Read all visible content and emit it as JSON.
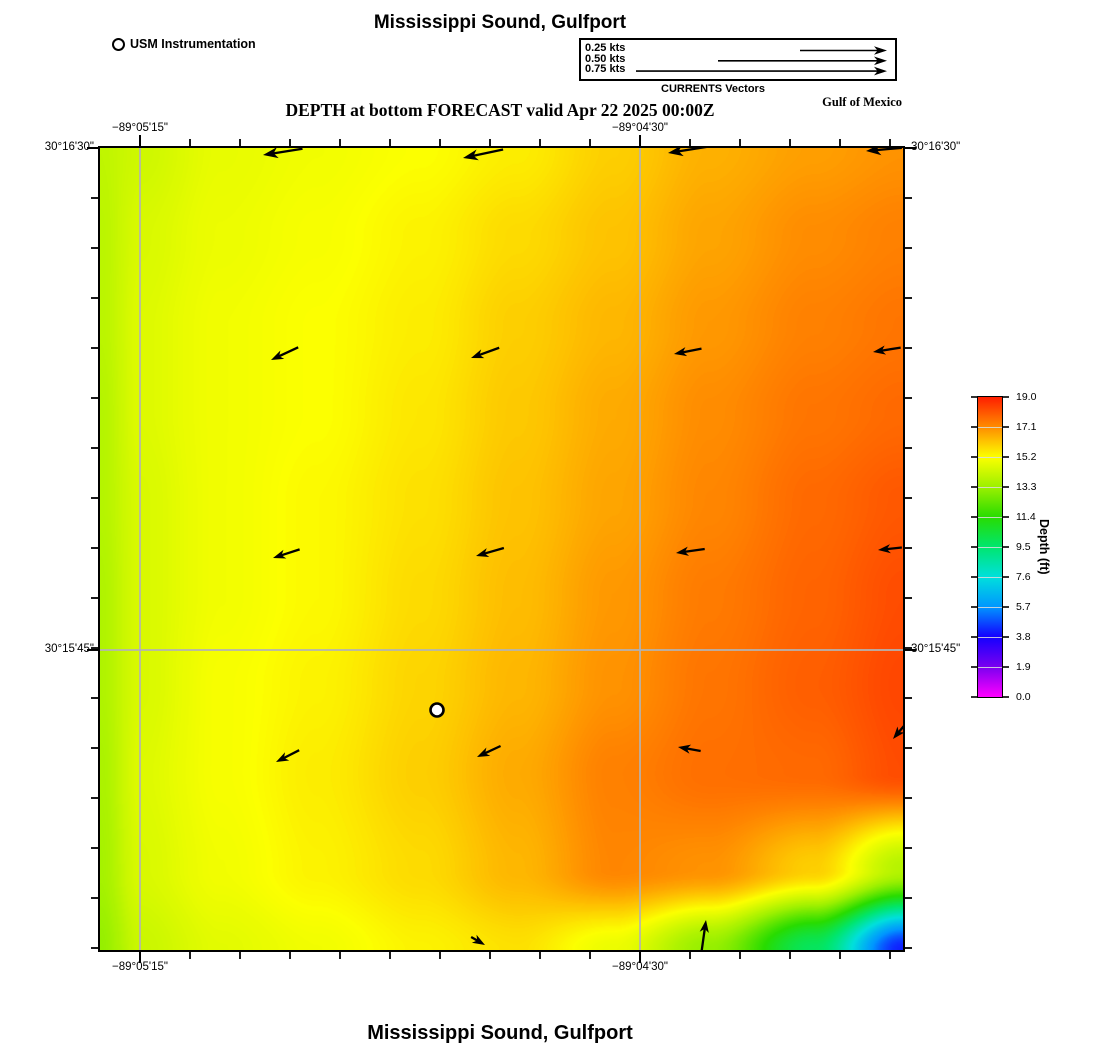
{
  "header": {
    "top_title": "Mississippi Sound, Gulfport",
    "station_legend": "USM Instrumentation",
    "scale": {
      "entries": [
        {
          "label": "0.25 kts",
          "len": 87
        },
        {
          "label": "0.50 kts",
          "len": 169
        },
        {
          "label": "0.75 kts",
          "len": 251
        }
      ],
      "caption": "CURRENTS Vectors"
    },
    "subtitle": "DEPTH at bottom FORECAST valid Apr 22 2025 00:00Z",
    "region_label": "Gulf of Mexico"
  },
  "footer": {
    "title": "Mississippi Sound, Gulfport"
  },
  "axes": {
    "lon": [
      {
        "frac": 0.0498,
        "label": "−89°05'15\""
      },
      {
        "frac": 0.6725,
        "label": "−89°04'30\""
      }
    ],
    "lat": [
      {
        "frac": 0.0,
        "label": "30°16'30\""
      },
      {
        "frac": 0.6259,
        "label": "30°15'45\""
      }
    ]
  },
  "colorbar": {
    "title": "Depth (ft)",
    "tick_labels": [
      "19.0",
      "17.1",
      "15.2",
      "13.3",
      "11.4",
      "9.5",
      "7.6",
      "5.7",
      "3.8",
      "1.9",
      "0.0"
    ]
  },
  "chart_data": {
    "type": "heatmap",
    "title": "DEPTH at bottom FORECAST valid Apr 22 2025 00:00Z",
    "units": "ft",
    "depth_range": [
      0,
      19
    ],
    "colormap": [
      [
        0.0,
        "#FF00FF"
      ],
      [
        1.9,
        "#7A00F0"
      ],
      [
        3.8,
        "#1400FF"
      ],
      [
        5.7,
        "#0096FF"
      ],
      [
        7.6,
        "#00E0DC"
      ],
      [
        9.5,
        "#00E66E"
      ],
      [
        11.4,
        "#28DC00"
      ],
      [
        13.3,
        "#9CF000"
      ],
      [
        15.2,
        "#FCFF00"
      ],
      [
        17.1,
        "#FF8C00"
      ],
      [
        19.0,
        "#FF1E00"
      ]
    ],
    "grid": {
      "cols_frac": [
        0,
        0.05,
        0.15,
        0.27,
        0.4,
        0.52,
        0.64,
        0.76,
        0.89,
        1
      ],
      "rows_frac": [
        0,
        0.11,
        0.22,
        0.33,
        0.44,
        0.56,
        0.67,
        0.78,
        0.9,
        1
      ],
      "depth_ft": [
        [
          14.0,
          14.3,
          14.8,
          15.0,
          15.2,
          15.5,
          16.0,
          16.5,
          16.8,
          17.0
        ],
        [
          13.9,
          14.5,
          14.9,
          15.1,
          15.4,
          15.8,
          16.2,
          16.7,
          17.1,
          17.3
        ],
        [
          13.9,
          14.6,
          15.0,
          15.2,
          15.5,
          16.0,
          16.4,
          16.9,
          17.3,
          17.5
        ],
        [
          13.8,
          14.6,
          15.0,
          15.2,
          15.6,
          16.1,
          16.6,
          17.1,
          17.5,
          17.7
        ],
        [
          13.8,
          14.5,
          15.0,
          15.3,
          15.7,
          16.2,
          16.7,
          17.2,
          17.7,
          18.0
        ],
        [
          13.7,
          14.5,
          15.0,
          15.3,
          15.8,
          16.3,
          16.9,
          17.4,
          17.8,
          18.2
        ],
        [
          13.7,
          14.5,
          15.1,
          15.4,
          15.9,
          16.4,
          17.0,
          17.5,
          17.9,
          18.3
        ],
        [
          13.6,
          14.6,
          15.1,
          15.5,
          16.0,
          16.6,
          17.3,
          17.6,
          17.7,
          18.2
        ],
        [
          13.5,
          14.5,
          15.0,
          15.4,
          15.8,
          16.4,
          17.2,
          17.0,
          16.0,
          13.8
        ],
        [
          13.2,
          14.2,
          14.7,
          15.0,
          15.4,
          15.7,
          14.9,
          13.2,
          9.8,
          4.2
        ]
      ]
    },
    "gridlines": {
      "x_frac": [
        0.0498,
        0.6725
      ],
      "y_frac": [
        0.6259
      ]
    },
    "ticks": {
      "x_start": 40,
      "x_step": 50,
      "x_count": 16,
      "y_start": 0,
      "y_step": 50,
      "y_count": 17
    },
    "vectors": [
      {
        "x": 163,
        "y": 7,
        "rot": 171,
        "len": 40
      },
      {
        "x": 363,
        "y": 10,
        "rot": 168,
        "len": 41
      },
      {
        "x": 568,
        "y": 5,
        "rot": 171,
        "len": 40
      },
      {
        "x": 766,
        "y": 3,
        "rot": 175,
        "len": 36
      },
      {
        "x": 171,
        "y": 212,
        "rot": 155,
        "len": 30
      },
      {
        "x": 371,
        "y": 210,
        "rot": 160,
        "len": 30
      },
      {
        "x": 574,
        "y": 206,
        "rot": 169,
        "len": 28
      },
      {
        "x": 773,
        "y": 204,
        "rot": 171,
        "len": 28
      },
      {
        "x": 173,
        "y": 410,
        "rot": 162,
        "len": 28
      },
      {
        "x": 376,
        "y": 408,
        "rot": 164,
        "len": 29
      },
      {
        "x": 576,
        "y": 405,
        "rot": 172,
        "len": 29
      },
      {
        "x": 778,
        "y": 402,
        "rot": 174,
        "len": 24
      },
      {
        "x": 176,
        "y": 614,
        "rot": 153,
        "len": 26
      },
      {
        "x": 377,
        "y": 609,
        "rot": 155,
        "len": 26
      },
      {
        "x": 578,
        "y": 599,
        "rot": 190,
        "len": 23
      },
      {
        "x": 793,
        "y": 591,
        "rot": 130,
        "len": 20
      },
      {
        "x": 385,
        "y": 797,
        "rot": 30,
        "len": 16
      },
      {
        "x": 606,
        "y": 772,
        "rot": -82,
        "len": 33
      }
    ],
    "station": {
      "x": 337,
      "y": 562,
      "label": "USM Instrumentation"
    }
  }
}
